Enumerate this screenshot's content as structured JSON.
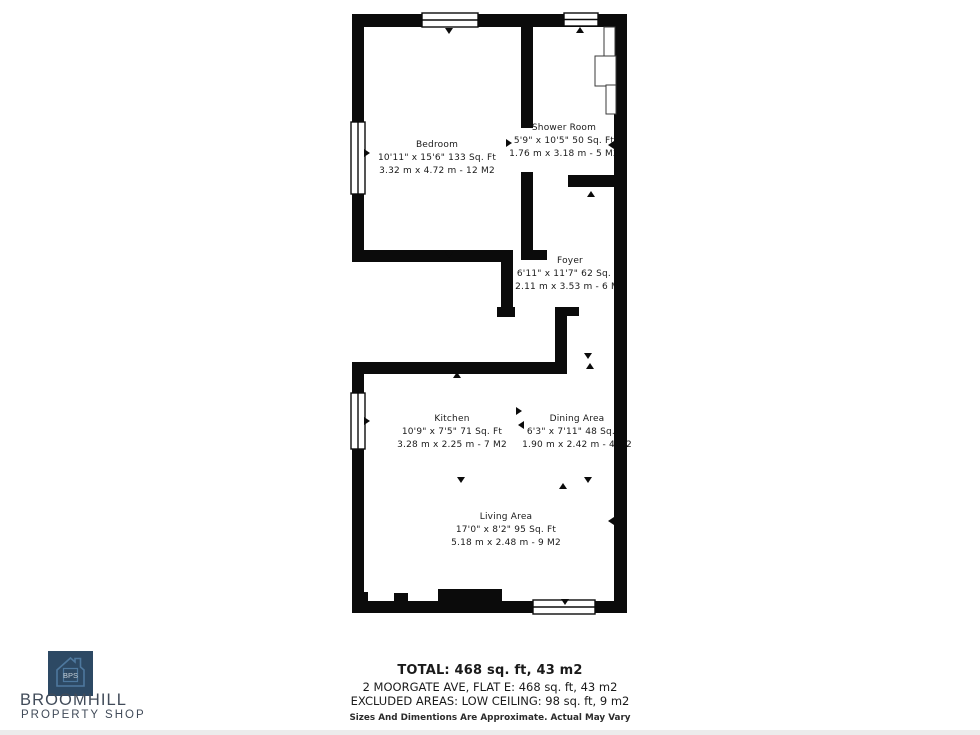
{
  "floorplan": {
    "wall_color": "#0b0b0b",
    "rooms": [
      {
        "id": "bedroom",
        "name": "Bedroom",
        "dims_ft": "10'11\" x 15'6\" 133 Sq. Ft",
        "dims_m": "3.32 m x 4.72 m - 12 M2"
      },
      {
        "id": "shower-room",
        "name": "Shower Room",
        "dims_ft": "5'9\" x 10'5\" 50 Sq. Ft",
        "dims_m": "1.76 m x 3.18 m - 5 M2"
      },
      {
        "id": "foyer",
        "name": "Foyer",
        "dims_ft": "6'11\" x 11'7\" 62 Sq. Ft",
        "dims_m": "2.11 m x 3.53 m - 6 M2"
      },
      {
        "id": "kitchen",
        "name": "Kitchen",
        "dims_ft": "10'9\" x 7'5\" 71 Sq. Ft",
        "dims_m": "3.28 m x 2.25 m - 7 M2"
      },
      {
        "id": "dining-area",
        "name": "Dining Area",
        "dims_ft": "6'3\" x 7'11\" 48 Sq. Ft",
        "dims_m": "1.90 m x 2.42 m - 4 M2"
      },
      {
        "id": "living-area",
        "name": "Living Area",
        "dims_ft": "17'0\" x 8'2\" 95 Sq. Ft",
        "dims_m": "5.18 m x 2.48 m - 9 M2"
      }
    ]
  },
  "summary": {
    "total": "TOTAL: 468 sq. ft, 43 m2",
    "address": "2 MOORGATE AVE, FLAT E: 468 sq. ft, 43 m2",
    "excluded": "EXCLUDED AREAS: LOW CEILING: 98 sq. ft, 9 m2",
    "disclaimer": "Sizes And Dimentions Are Approximate. Actual May Vary"
  },
  "branding": {
    "icon_text": "BPS",
    "name_line1": "BROOMHILL",
    "name_line2": "PROPERTY SHOP",
    "logo_bg": "#2d4964",
    "logo_house_color": "#4e789e",
    "wordmark_color": "#414b59"
  }
}
